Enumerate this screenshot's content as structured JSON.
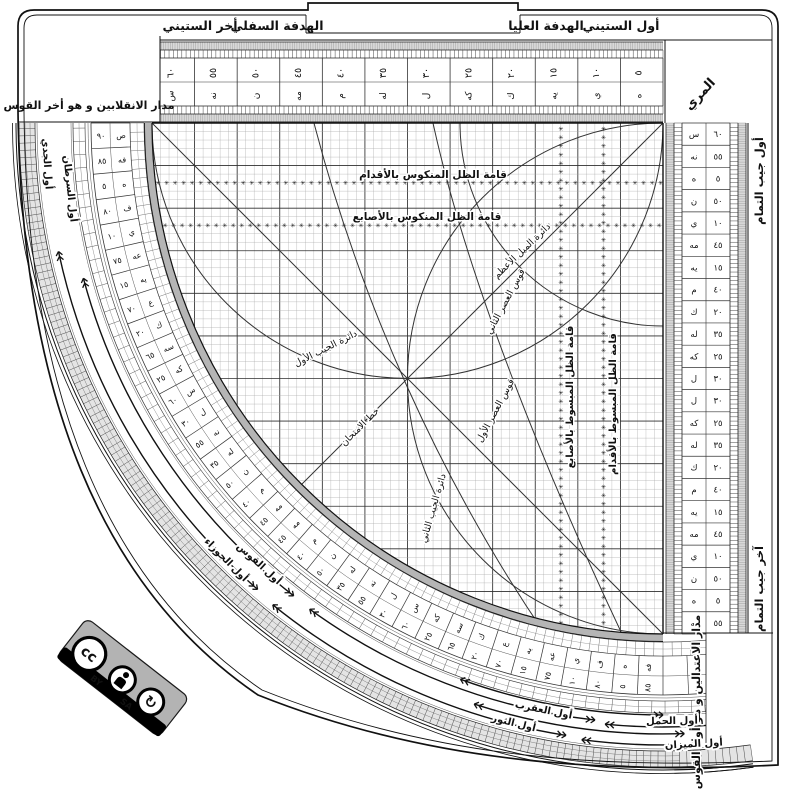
{
  "top_band": {
    "awwal_sittini": "أول الستيني",
    "hadafa_ulya": "الهدفة العليا",
    "hadafa_sufla": "الهدفة السفلي",
    "akhir_sittini": "أخر الستيني"
  },
  "corners": {
    "top_left": "مدار الانقلابين و هو أخر القوس",
    "bottom_right": "مدار الاعتدالين و هو أول القوس",
    "muri": "المري"
  },
  "cosine_scale": {
    "start": "أول جيب التمام",
    "end": "آخر جيب التمام"
  },
  "grid_labels": {
    "mankus_aqdam": "قامة الظل المنكوس بالأقدام",
    "mankus_asabi": "قامة الظل المنكوس بالأصابع",
    "mabsut_asabi": "قامة الظل المبسوط بالأصابع",
    "mabsut_aqdam": "قامة الظل المبسوط بالأقدام",
    "mayl_azam": "دائرة الميل الأعظم",
    "asr_awwal": "قوس العصر الأول",
    "asr_thani": "قوس العصر الثاني",
    "imtihan": "خط الامتحان",
    "jayb_awwal": "دائرة الجيب الأول",
    "jayb_thani": "دائرة الجيب الثاني"
  },
  "zodiac_labels": [
    "أول الجدي",
    "أول السرطان",
    "أول الجوزاء",
    "أول القوس",
    "أول الثور",
    "أول العقرب",
    "أول الحمل",
    "أول الميزان"
  ],
  "scales": {
    "top_values": [
      5,
      10,
      15,
      20,
      25,
      30,
      35,
      40,
      45,
      50,
      55,
      60
    ],
    "arc_main": [
      90,
      85,
      80,
      75,
      70,
      65,
      60,
      55,
      50,
      45,
      40,
      35,
      30,
      25,
      20,
      15,
      10,
      5
    ],
    "vertical_main": [
      60,
      55,
      50,
      45,
      40,
      35,
      30,
      25,
      20,
      15,
      10,
      5
    ],
    "abjad": {
      "5": "ه",
      "10": "ي",
      "15": "يه",
      "20": "ك",
      "25": "كه",
      "30": "ل",
      "35": "له",
      "40": "م",
      "45": "مه",
      "50": "ن",
      "55": "نه",
      "60": "س",
      "65": "سه",
      "70": "ع",
      "75": "عه",
      "80": "ف",
      "85": "فه",
      "90": "ص"
    }
  },
  "license": {
    "cc": "cc",
    "by": "BY",
    "sa": "SA"
  }
}
